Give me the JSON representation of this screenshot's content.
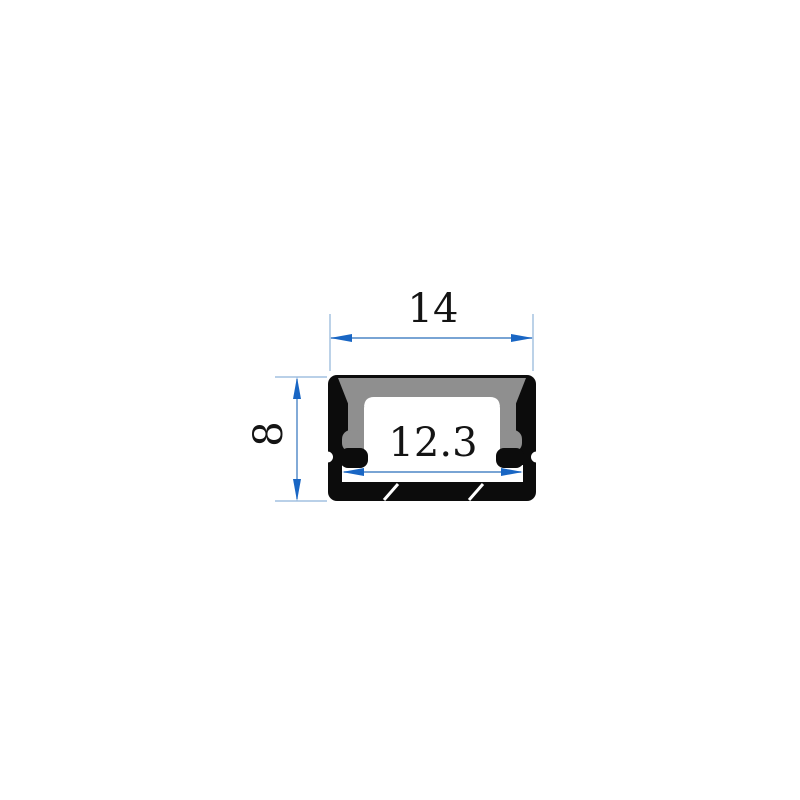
{
  "drawing": {
    "type": "profile-cross-section-technical-drawing",
    "dimensions": {
      "width_top": "14",
      "height_left": "8",
      "inner_width": "12.3"
    },
    "colors": {
      "background": "#ffffff",
      "profile_black": "#0c0c0c",
      "cover_gray": "#8f8f8f",
      "cavity_white": "#ffffff",
      "arrow_blue": "#1966c4",
      "dim_line_blue": "#4d86c6",
      "extension_blue": "#8fb3d9",
      "text_black": "#141414"
    }
  }
}
